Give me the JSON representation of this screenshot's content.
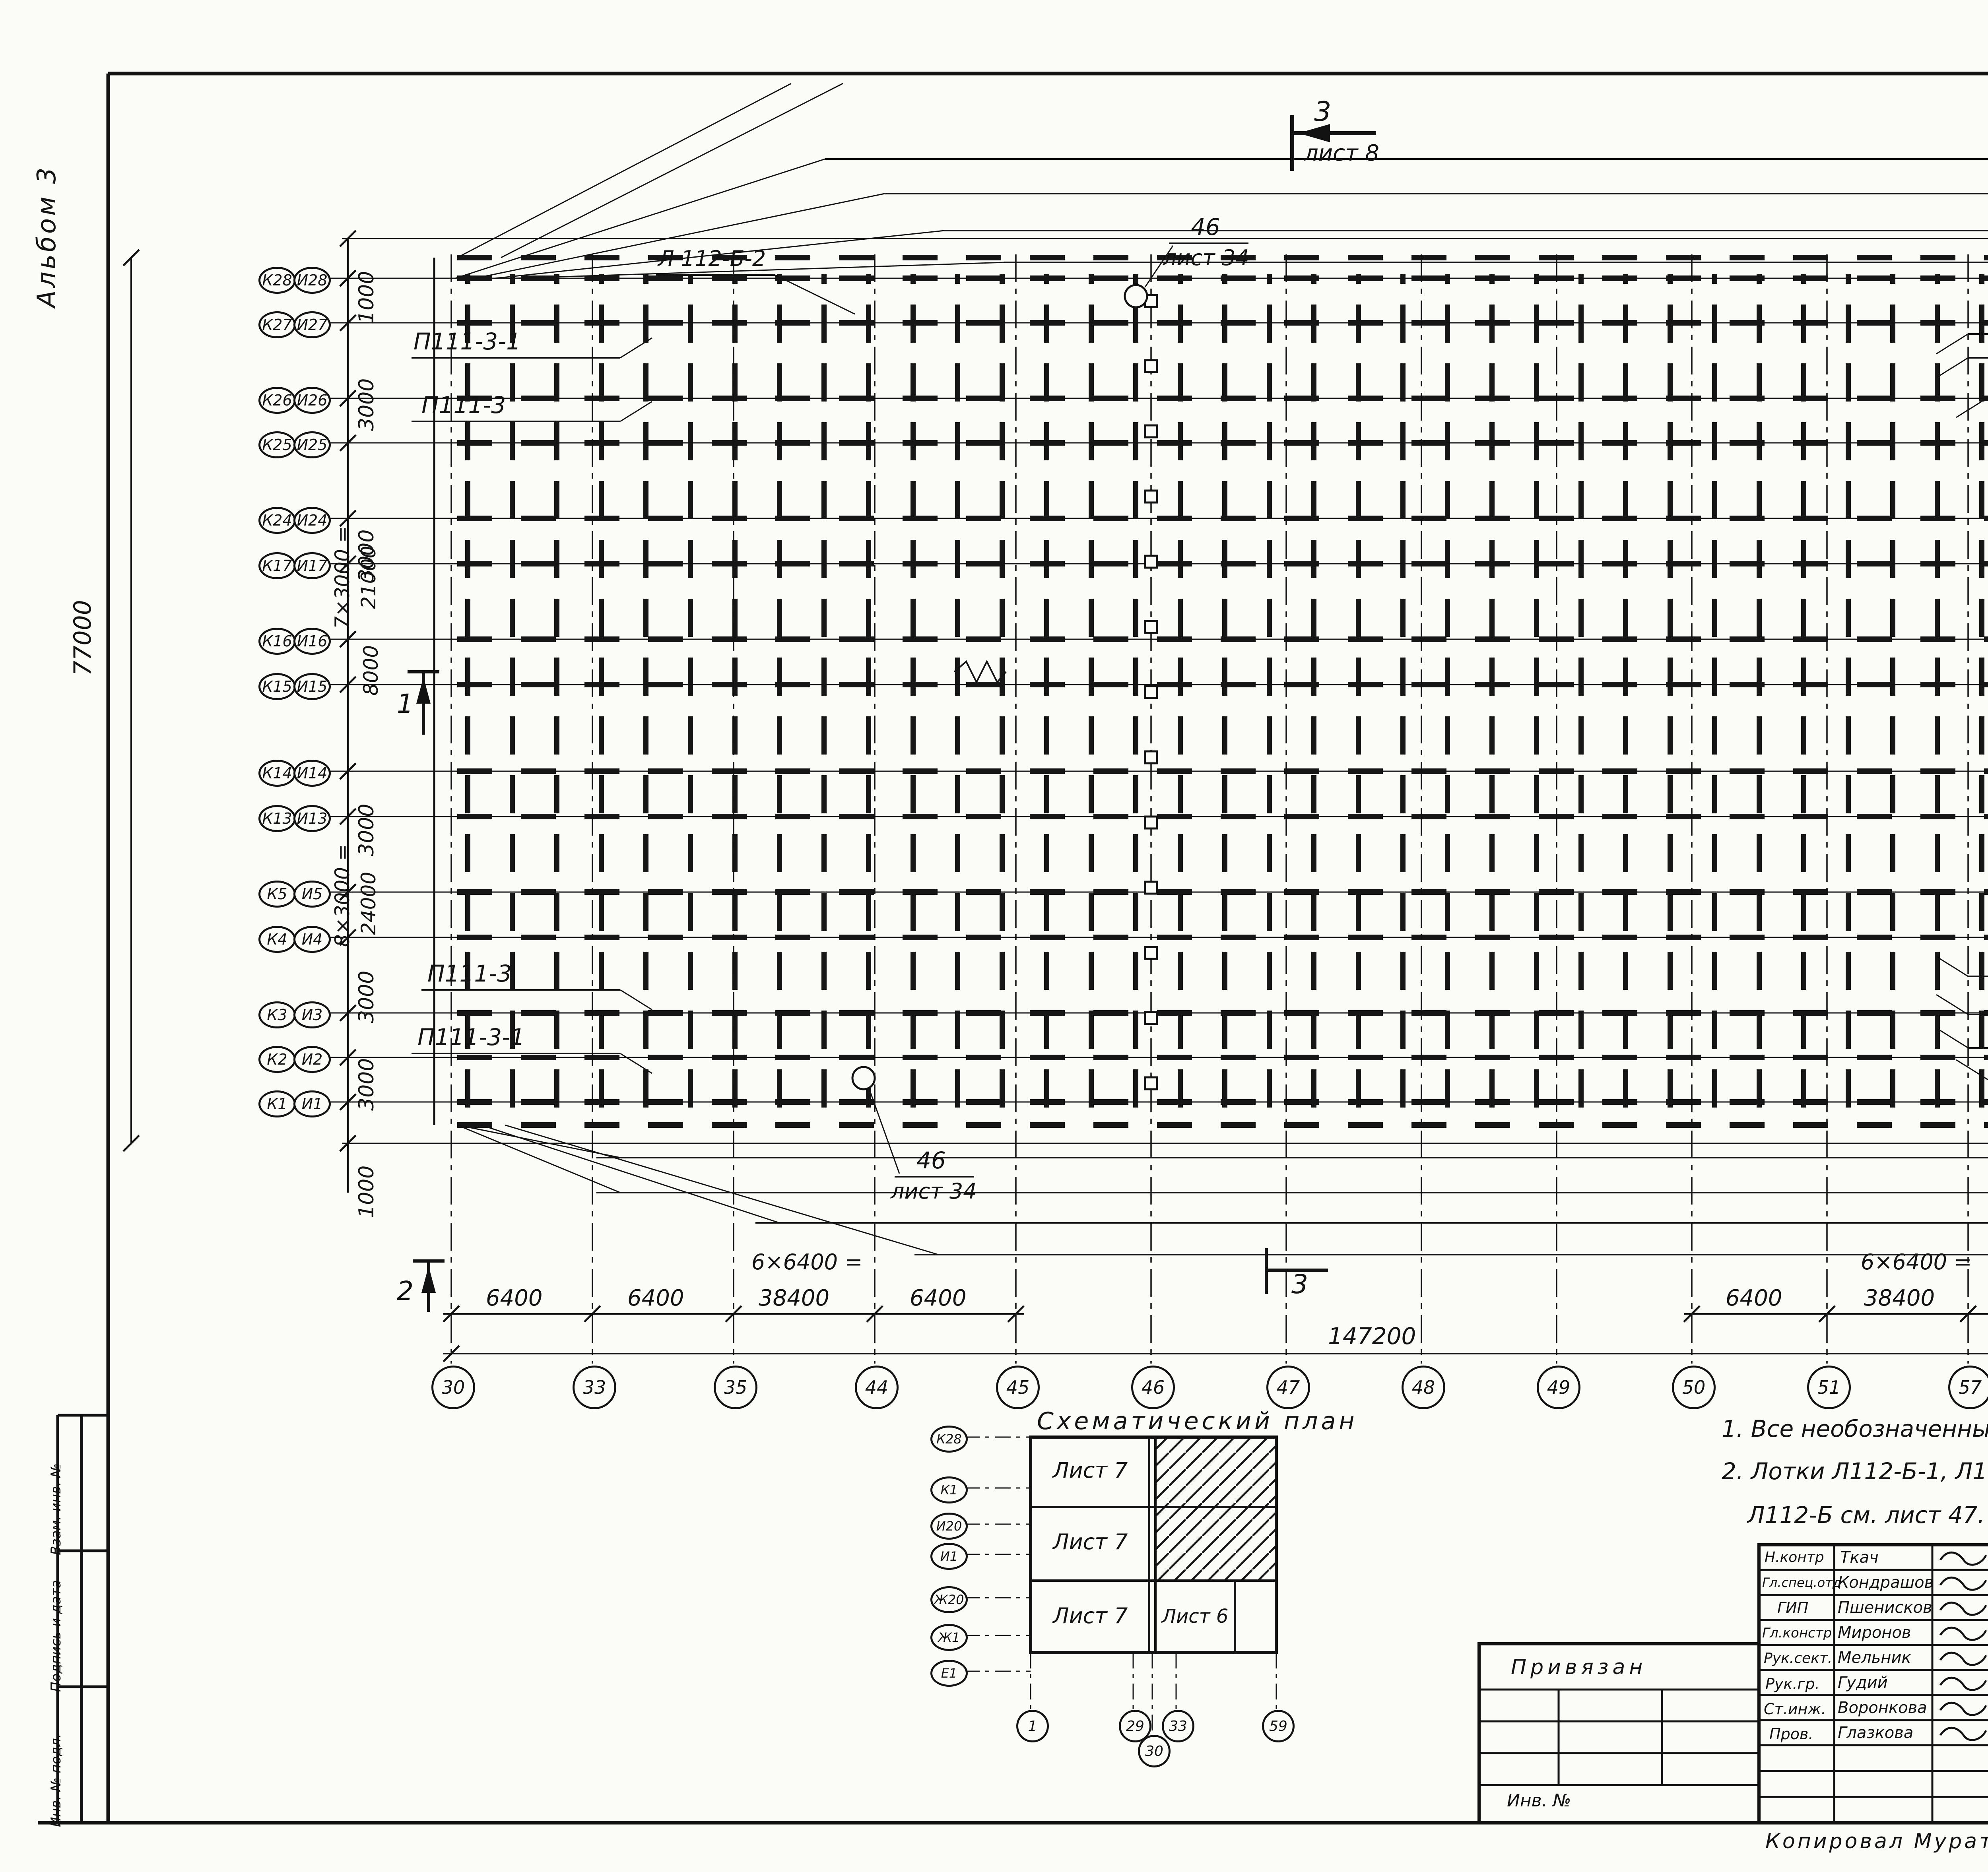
{
  "sheet": {
    "page_number": "7",
    "album": "Альбом 3",
    "format": "Формат А2",
    "copied": "Копировал  Муратова",
    "archive_no": "23534-03   8"
  },
  "margin_strip": {
    "top": "Взам. инв. №",
    "middle": "Подпись и дата",
    "bottom": "Инв. № подл."
  },
  "rows": [
    {
      "k": "К28",
      "i": "И28"
    },
    {
      "k": "К27",
      "i": "И27"
    },
    {
      "k": "К26",
      "i": "И26"
    },
    {
      "k": "К25",
      "i": "И25"
    },
    {
      "k": "К24",
      "i": "И24"
    },
    {
      "k": "К17",
      "i": "И17"
    },
    {
      "k": "К16",
      "i": "И16"
    },
    {
      "k": "К15",
      "i": "И15"
    },
    {
      "k": "К14",
      "i": "И14"
    },
    {
      "k": "К13",
      "i": "И13"
    },
    {
      "k": "К5",
      "i": "И5"
    },
    {
      "k": "К4",
      "i": "И4"
    },
    {
      "k": "К3",
      "i": "И3"
    },
    {
      "k": "К2",
      "i": "И2"
    },
    {
      "k": "К1",
      "i": "И1"
    }
  ],
  "cols": [
    "30",
    "33",
    "35",
    "44",
    "45",
    "46",
    "47",
    "48",
    "49",
    "50",
    "51",
    "57",
    "58",
    "59"
  ],
  "vdims": {
    "d1000t": "1000",
    "d3000a": "3000",
    "d3000b": "3000",
    "d7x": "7×3000 =",
    "d21000": "21000",
    "d8000": "8000",
    "d77000": "77000",
    "d3000c": "3000",
    "d8x": "8×3000 =",
    "d24000": "24000",
    "d3000d": "3000",
    "d3000e": "3000",
    "d1000b": "1000"
  },
  "hdims": {
    "left": [
      "6400",
      "6400",
      "38400",
      "6400"
    ],
    "left_eq": "6×6400 =",
    "right": [
      "6400",
      "38400",
      "6400",
      "6400"
    ],
    "right_eq": "6×6400 =",
    "total": "147200"
  },
  "labels": {
    "rt": [
      "Р112-1",
      "Р111-4",
      "С111-18",
      "ВФ111-Б"
    ],
    "ru": [
      "П112-1-1",
      "П111-2-1",
      "П112-1",
      "П111- 2"
    ],
    "ru_inline": "Л112-Б",
    "rm": [
      "Л112-Б-1",
      "Л 112-Б",
      "Л 112-Б-1",
      "Л112-Б"
    ],
    "rl": [
      "П111-2",
      "П112-1",
      "П111-2-1",
      "П112-1-1"
    ],
    "rl_inline": "Л112-Б",
    "rb": [
      "Л112-Б-2",
      "ВФ 111-Б",
      "С 111-18",
      "Р 111-4",
      "Р 112-1"
    ],
    "lt": [
      "П111-3-1",
      "П111-3"
    ],
    "lb": [
      "П111-3",
      "П111-3-1"
    ],
    "l_top": "Л 112-Б-2",
    "ref46": "46",
    "ref46_sheet": "лист 34"
  },
  "sections": {
    "s1": "1",
    "s2": "2",
    "s3": "3",
    "sheet8": "лист 8"
  },
  "schematic": {
    "title": "Схематический план",
    "cell7": "Лист 7",
    "cell6": "Лист 6",
    "rows": [
      "К28",
      "К1",
      "И20",
      "И1",
      "Ж20",
      "Ж1",
      "Е1"
    ],
    "cols": [
      "1",
      "29",
      "30",
      "33",
      "59"
    ]
  },
  "notes": [
    "1. Все необозначенные  на схеме стойки  марки К111-1.",
    "2. Лотки Л112-Б-1, Л112-Б-2  выполнить из лотка Л112-Б . Доработку лотка",
    "Л112-Б  см. лист 47."
  ],
  "tb": {
    "doc": "т. п.  810-1-30.88",
    "km": "КМ1",
    "sig_rows": [
      {
        "r": "Н.контр",
        "n": "Ткач",
        "d": "14.10.88"
      },
      {
        "r": "Гл.спец.отд",
        "n": "Кондрашов",
        "d": "03.10.88"
      },
      {
        "r": "ГИП",
        "n": "Пшенисков",
        "d": "03.10.88"
      },
      {
        "r": "Гл.констр",
        "n": "Миронов",
        "d": "03.10.88"
      },
      {
        "r": "Рук.сект.",
        "n": "Мельник",
        "d": "03.10.88"
      },
      {
        "r": "Рук.гр.",
        "n": "Гудий",
        "d": "03.10.88"
      },
      {
        "r": "Ст.инж.",
        "n": "Воронкова",
        "d": "03.10.88"
      },
      {
        "r": "Пров.",
        "n": "Глазкова",
        "d": "03.10.88"
      }
    ],
    "object1": "Блок зимних почвенных теплиц",
    "object2": "площадью 6га (под одной",
    "object3": "кровлей)  для tн = -40°С.",
    "title1": "Схема расположения стоек,",
    "title2": "ригелей, прогонов и лотков",
    "title3": "конденсата  Теплицы 1, 2.",
    "stage_h": "Стадия",
    "list_h": "Лист",
    "lists_h": "Листов",
    "stage": "РП",
    "list": "5",
    "lists": "",
    "org": "ГИПРОНИСЕЛЬПРОМ",
    "city": "г. Орел",
    "bind_label": "Привязан",
    "inv": "Инв. №"
  }
}
